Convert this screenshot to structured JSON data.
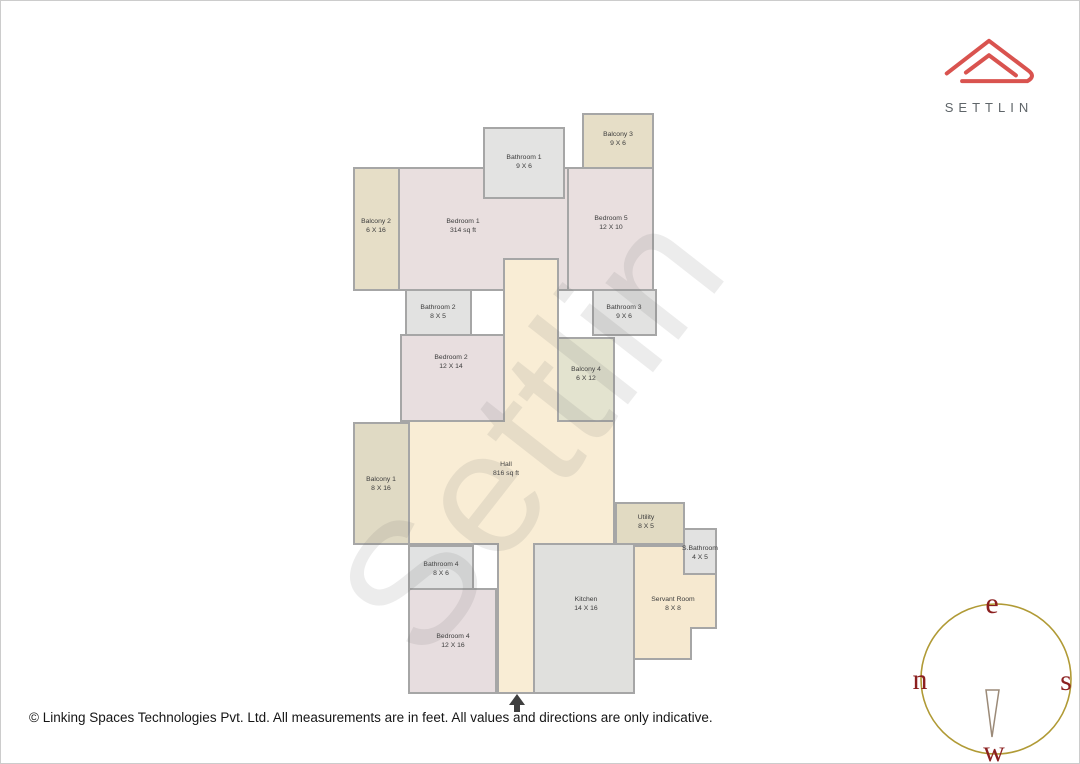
{
  "branding": {
    "name": "SETTLIN",
    "logo_color": "#d9534f",
    "logo_text_color": "#5f6569"
  },
  "watermark": {
    "text": "Settlin"
  },
  "footer": {
    "copyright": "© Linking Spaces Technologies Pvt. Ltd. All measurements are in feet. All values and directions are only indicative."
  },
  "compass": {
    "top": "e",
    "left": "n",
    "right": "s",
    "bottom": "w",
    "ring_color": "#b09a35",
    "letter_color": "#8b1f1f",
    "needle_stroke": "#9b8a78"
  },
  "floorplan": {
    "wall_color": "#a6a6a6",
    "label_color": "#3c3c3c",
    "entrance_arrow_color": "#3f3f3f",
    "rooms": [
      {
        "id": "balcony-2",
        "name": "Balcony 2",
        "dims": "6 X 16",
        "fill": "#e6dec7",
        "x": 353,
        "y": 167,
        "w": 45,
        "h": 122,
        "lx": 375,
        "ly": 222
      },
      {
        "id": "bedroom-1",
        "name": "Bedroom 1",
        "dims": "314 sq ft",
        "fill": "#e9dfdf",
        "x": 398,
        "y": 167,
        "w": 169,
        "h": 122,
        "lx": 462,
        "ly": 222
      },
      {
        "id": "bedroom-5",
        "name": "Bedroom 5",
        "dims": "12 X 10",
        "fill": "#e9dfdf",
        "x": 567,
        "y": 167,
        "w": 85,
        "h": 122,
        "lx": 610,
        "ly": 219
      },
      {
        "id": "bathroom-1",
        "name": "Bathroom 1",
        "dims": "9 X 6",
        "fill": "#e3e3e2",
        "x": 483,
        "y": 127,
        "w": 80,
        "h": 70,
        "lx": 523,
        "ly": 158
      },
      {
        "id": "balcony-3",
        "name": "Balcony 3",
        "dims": "9 X 6",
        "fill": "#e6dec7",
        "x": 582,
        "y": 113,
        "w": 70,
        "h": 54,
        "lx": 617,
        "ly": 135
      },
      {
        "id": "bathroom-2",
        "name": "Bathroom 2",
        "dims": "8 X 5",
        "fill": "#e2e2e1",
        "x": 405,
        "y": 289,
        "w": 65,
        "h": 45,
        "lx": 437,
        "ly": 308
      },
      {
        "id": "bathroom-3",
        "name": "Bathroom 3",
        "dims": "9 X 6",
        "fill": "#e2e2e1",
        "x": 592,
        "y": 289,
        "w": 63,
        "h": 45,
        "lx": 623,
        "ly": 308
      },
      {
        "id": "bedroom-2",
        "name": "Bedroom 2",
        "dims": "12 X 14",
        "fill": "#e8dedf",
        "x": 400,
        "y": 334,
        "w": 103,
        "h": 86,
        "lx": 450,
        "ly": 358
      },
      {
        "id": "balcony-4",
        "name": "Balcony 4",
        "dims": "6 X 12",
        "fill": "#e3e3cf",
        "x": 557,
        "y": 337,
        "w": 56,
        "h": 83,
        "lx": 585,
        "ly": 370
      },
      {
        "id": "hall",
        "name": "Hall",
        "dims": "816 sq ft",
        "fill": "#f9edd5",
        "path": "M503,258 L557,258 L557,420 L613,420 L613,543 L533,543 L533,692 L497,692 L497,543 L408,543 L408,420 L503,420 Z",
        "lx": 505,
        "ly": 465
      },
      {
        "id": "balcony-1",
        "name": "Balcony 1",
        "dims": "8 X 16",
        "fill": "#e0dac4",
        "x": 353,
        "y": 422,
        "w": 55,
        "h": 121,
        "lx": 380,
        "ly": 480
      },
      {
        "id": "utility",
        "name": "Utility",
        "dims": "8 X 5",
        "fill": "#e1dac2",
        "x": 615,
        "y": 502,
        "w": 68,
        "h": 41,
        "lx": 645,
        "ly": 518
      },
      {
        "id": "bathroom-4",
        "name": "Bathroom 4",
        "dims": "8 X 6",
        "fill": "#e1e2e2",
        "x": 408,
        "y": 545,
        "w": 64,
        "h": 43,
        "lx": 440,
        "ly": 565
      },
      {
        "id": "bedroom-4",
        "name": "Bedroom 4",
        "dims": "12 X 16",
        "fill": "#e7dddf",
        "x": 408,
        "y": 588,
        "w": 87,
        "h": 104,
        "lx": 452,
        "ly": 637
      },
      {
        "id": "kitchen",
        "name": "Kitchen",
        "dims": "14 X 16",
        "fill": "#e0e0dd",
        "x": 533,
        "y": 543,
        "w": 100,
        "h": 149,
        "lx": 585,
        "ly": 600
      },
      {
        "id": "servant-room",
        "name": "Servant Room",
        "dims": "8 X 8",
        "fill": "#f6e9d0",
        "path": "M633,545 L683,545 L683,573 L715,573 L715,627 L690,627 L690,658 L633,658 Z",
        "lx": 672,
        "ly": 600
      },
      {
        "id": "s-bathroom",
        "name": "S.Bathroom",
        "dims": "4 X 5",
        "fill": "#e2e2e1",
        "x": 683,
        "y": 528,
        "w": 32,
        "h": 45,
        "lx": 699,
        "ly": 549
      }
    ]
  }
}
